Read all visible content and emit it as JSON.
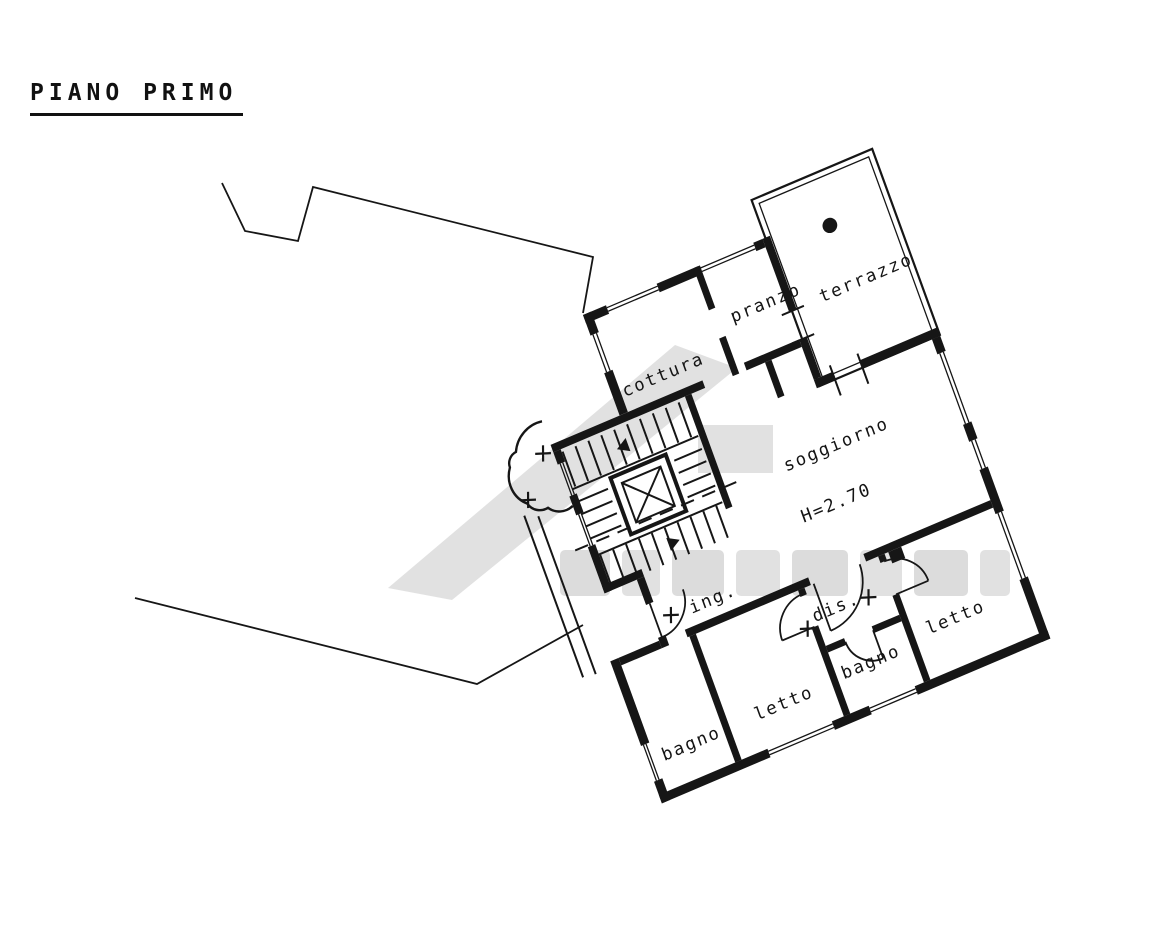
{
  "title": "PIANO PRIMO",
  "plan": {
    "rooms": [
      {
        "id": "cottura",
        "label": "cottura"
      },
      {
        "id": "pranzo",
        "label": "pranzo"
      },
      {
        "id": "terrazzo",
        "label": "terrazzo"
      },
      {
        "id": "soggiorno",
        "label": "soggiorno"
      },
      {
        "id": "ingresso",
        "label": "ing."
      },
      {
        "id": "disimpegno",
        "label": "dis."
      },
      {
        "id": "bagno-1",
        "label": "bagno"
      },
      {
        "id": "letto-1",
        "label": "letto"
      },
      {
        "id": "bagno-2",
        "label": "bagno"
      },
      {
        "id": "letto-2",
        "label": "letto"
      }
    ],
    "annotations": {
      "ceiling_height": "H=2.70"
    },
    "colors": {
      "ink": "#161616",
      "paper": "#ffffff",
      "watermark": "#d9d9d9"
    }
  }
}
